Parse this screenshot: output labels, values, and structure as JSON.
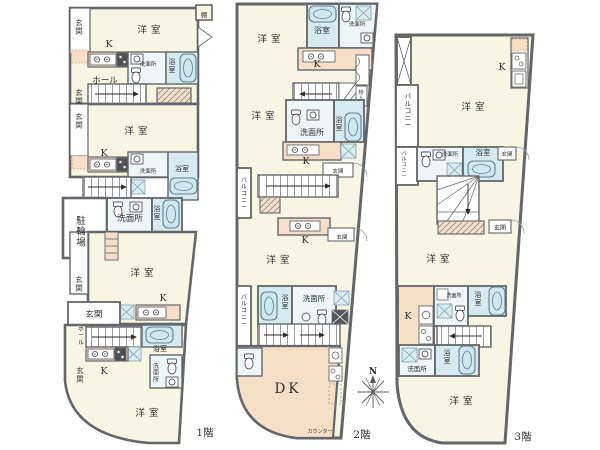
{
  "document_type": "apartment-floor-plan",
  "palette": {
    "wall": "#63666a",
    "thin_line": "#8b8e92",
    "room_cream": "#f8f6e3",
    "kitchen_peach": "#f6dfc6",
    "bath_blue": "#d6ebf1",
    "washroom_tint": "#eef6f8",
    "tub_fill": "#cfe7f0",
    "fixture_dark": "#4d4f52",
    "text": "#2e2e2e"
  },
  "annotations": [
    {
      "name": "compass-north-label",
      "text": "N",
      "x": 373,
      "y": 374,
      "size": 9,
      "bold": true
    }
  ],
  "floors": [
    {
      "id": "floor-1",
      "labels": [
        {
          "name": "shelf-label",
          "text": "棚",
          "x": 204,
          "y": 17,
          "size": 6.5
        },
        {
          "name": "entrance-label",
          "text": "玄関",
          "x": 79,
          "y": 25,
          "size": 7.5,
          "vertical": true
        },
        {
          "name": "western-room-label",
          "text": "洋室",
          "x": 151,
          "y": 33,
          "size": 9.5,
          "ls": 4
        },
        {
          "name": "kitchen-label",
          "text": "K",
          "x": 109,
          "y": 47,
          "size": 9.5
        },
        {
          "name": "washroom-label",
          "text": "洗面所",
          "x": 148,
          "y": 66,
          "size": 5.5
        },
        {
          "name": "bathroom-label",
          "text": "浴室",
          "x": 172,
          "y": 64,
          "size": 7,
          "vertical": true
        },
        {
          "name": "hall-label",
          "text": "ホール",
          "x": 105,
          "y": 83,
          "size": 8.5
        },
        {
          "name": "entrance-label",
          "text": "玄関",
          "x": 79,
          "y": 95,
          "size": 7.5,
          "vertical": true
        },
        {
          "name": "entrance-label",
          "text": "玄関",
          "x": 79,
          "y": 119,
          "size": 7.5,
          "vertical": true
        },
        {
          "name": "western-room-label",
          "text": "洋室",
          "x": 138,
          "y": 134,
          "size": 9.5,
          "ls": 4
        },
        {
          "name": "kitchen-label",
          "text": "K",
          "x": 104,
          "y": 156,
          "size": 9.5
        },
        {
          "name": "washroom-label",
          "text": "洗面所",
          "x": 148,
          "y": 173,
          "size": 5.5
        },
        {
          "name": "bathroom-label",
          "text": "浴室",
          "x": 182,
          "y": 171,
          "size": 7
        },
        {
          "name": "bicycle-parking-label",
          "text": "駐輪場",
          "x": 81,
          "y": 224,
          "size": 9.5,
          "vertical": true
        },
        {
          "name": "washroom-label",
          "text": "洗面所",
          "x": 130,
          "y": 221,
          "size": 8.5
        },
        {
          "name": "bathroom-label",
          "text": "浴室",
          "x": 157,
          "y": 211,
          "size": 7,
          "vertical": true
        },
        {
          "name": "western-room-label",
          "text": "洋室",
          "x": 144,
          "y": 276,
          "size": 9.5,
          "ls": 4
        },
        {
          "name": "entrance-label",
          "text": "玄関",
          "x": 79,
          "y": 282,
          "size": 7.5,
          "vertical": true
        },
        {
          "name": "kitchen-label",
          "text": "K",
          "x": 163,
          "y": 301,
          "size": 9.5
        },
        {
          "name": "entrance-label",
          "text": "玄関",
          "x": 94,
          "y": 317,
          "size": 8.5
        },
        {
          "name": "hall-label",
          "text": "ホール",
          "x": 81,
          "y": 331,
          "size": 6,
          "vertical": true
        },
        {
          "name": "bathroom-label",
          "text": "浴室",
          "x": 160,
          "y": 351,
          "size": 7
        },
        {
          "name": "washroom-label",
          "text": "洗面所",
          "x": 156,
          "y": 368,
          "size": 6,
          "vertical": true
        },
        {
          "name": "entrance-label",
          "text": "玄関",
          "x": 80,
          "y": 373,
          "size": 7.5,
          "vertical": true
        },
        {
          "name": "kitchen-label",
          "text": "K",
          "x": 104,
          "y": 374,
          "size": 9.5
        },
        {
          "name": "western-room-label",
          "text": "洋室",
          "x": 149,
          "y": 416,
          "size": 9.5,
          "ls": 4
        },
        {
          "name": "floor-number-label",
          "text": "1階",
          "x": 205,
          "y": 436,
          "size": 10.5
        }
      ]
    },
    {
      "id": "floor-2",
      "labels": [
        {
          "name": "bathroom-label",
          "text": "浴室",
          "x": 322,
          "y": 33,
          "size": 8
        },
        {
          "name": "washroom-label",
          "text": "洗面所",
          "x": 357,
          "y": 26,
          "size": 5.5
        },
        {
          "name": "western-room-label",
          "text": "洋室",
          "x": 271,
          "y": 42,
          "size": 9.5,
          "ls": 4
        },
        {
          "name": "kitchen-label",
          "text": "K",
          "x": 317,
          "y": 67,
          "size": 9.5
        },
        {
          "name": "storage-label",
          "text": "物入",
          "x": 361,
          "y": 94,
          "size": 5,
          "vertical": true
        },
        {
          "name": "western-room-label",
          "text": "洋室",
          "x": 265,
          "y": 119,
          "size": 9.5,
          "ls": 4
        },
        {
          "name": "washroom-label",
          "text": "洗面所",
          "x": 312,
          "y": 135,
          "size": 8
        },
        {
          "name": "bathroom-label",
          "text": "浴室",
          "x": 339,
          "y": 122,
          "size": 7,
          "vertical": true
        },
        {
          "name": "kitchen-label",
          "text": "K",
          "x": 306,
          "y": 164,
          "size": 9.5
        },
        {
          "name": "entrance-label",
          "text": "玄関",
          "x": 338,
          "y": 173,
          "size": 5.5
        },
        {
          "name": "balcony-label",
          "text": "バルコニー",
          "x": 244,
          "y": 182,
          "size": 6,
          "vertical": true
        },
        {
          "name": "kitchen-label",
          "text": "K",
          "x": 305,
          "y": 243,
          "size": 9.5
        },
        {
          "name": "entrance-label",
          "text": "玄関",
          "x": 342,
          "y": 239,
          "size": 5.5
        },
        {
          "name": "western-room-label",
          "text": "洋室",
          "x": 280,
          "y": 263,
          "size": 9.5,
          "ls": 4
        },
        {
          "name": "bathroom-label",
          "text": "浴室",
          "x": 285,
          "y": 300,
          "size": 7,
          "vertical": true
        },
        {
          "name": "washroom-label",
          "text": "洗面所",
          "x": 314,
          "y": 301,
          "size": 7.5
        },
        {
          "name": "balcony-label",
          "text": "バルコニー",
          "x": 244,
          "y": 299,
          "size": 6,
          "vertical": true
        },
        {
          "name": "dining-kitchen-label",
          "text": "DK",
          "x": 288,
          "y": 393,
          "size": 13.5,
          "ls": 3
        },
        {
          "name": "counter-label",
          "text": "カウンター",
          "x": 320,
          "y": 433,
          "size": 5
        },
        {
          "name": "floor-number-label",
          "text": "2階",
          "x": 362,
          "y": 438,
          "size": 10.5
        }
      ]
    },
    {
      "id": "floor-3",
      "labels": [
        {
          "name": "kitchen-label",
          "text": "K",
          "x": 502,
          "y": 70,
          "size": 9.5
        },
        {
          "name": "western-room-label",
          "text": "洋室",
          "x": 475,
          "y": 110,
          "size": 9.5,
          "ls": 4
        },
        {
          "name": "balcony-label",
          "text": "バルコニー",
          "x": 408,
          "y": 98,
          "size": 6.5,
          "vertical": true
        },
        {
          "name": "balcony-label",
          "text": "バルコニー",
          "x": 404,
          "y": 155,
          "size": 5,
          "vertical": true
        },
        {
          "name": "washroom-label",
          "text": "洗面所",
          "x": 450,
          "y": 156,
          "size": 5.5
        },
        {
          "name": "bathroom-label",
          "text": "浴室",
          "x": 483,
          "y": 155,
          "size": 7.5
        },
        {
          "name": "entrance-label",
          "text": "玄関",
          "x": 507,
          "y": 156,
          "size": 5.5
        },
        {
          "name": "entrance-label",
          "text": "玄関",
          "x": 500,
          "y": 230,
          "size": 6
        },
        {
          "name": "western-room-label",
          "text": "洋室",
          "x": 440,
          "y": 262,
          "size": 9.5,
          "ls": 4
        },
        {
          "name": "kitchen-label",
          "text": "K",
          "x": 408,
          "y": 319,
          "size": 9.5
        },
        {
          "name": "washroom-label",
          "text": "洗面所",
          "x": 454,
          "y": 297,
          "size": 5
        },
        {
          "name": "bathroom-label",
          "text": "浴室",
          "x": 478,
          "y": 297,
          "size": 7,
          "vertical": true
        },
        {
          "name": "washroom-label",
          "text": "洗面所",
          "x": 417,
          "y": 371,
          "size": 6.5
        },
        {
          "name": "bathroom-label",
          "text": "浴室",
          "x": 447,
          "y": 355,
          "size": 7,
          "vertical": true
        },
        {
          "name": "western-room-label",
          "text": "洋室",
          "x": 463,
          "y": 404,
          "size": 9.5,
          "ls": 4
        },
        {
          "name": "floor-number-label",
          "text": "3階",
          "x": 523,
          "y": 440,
          "size": 10.5
        }
      ]
    }
  ]
}
